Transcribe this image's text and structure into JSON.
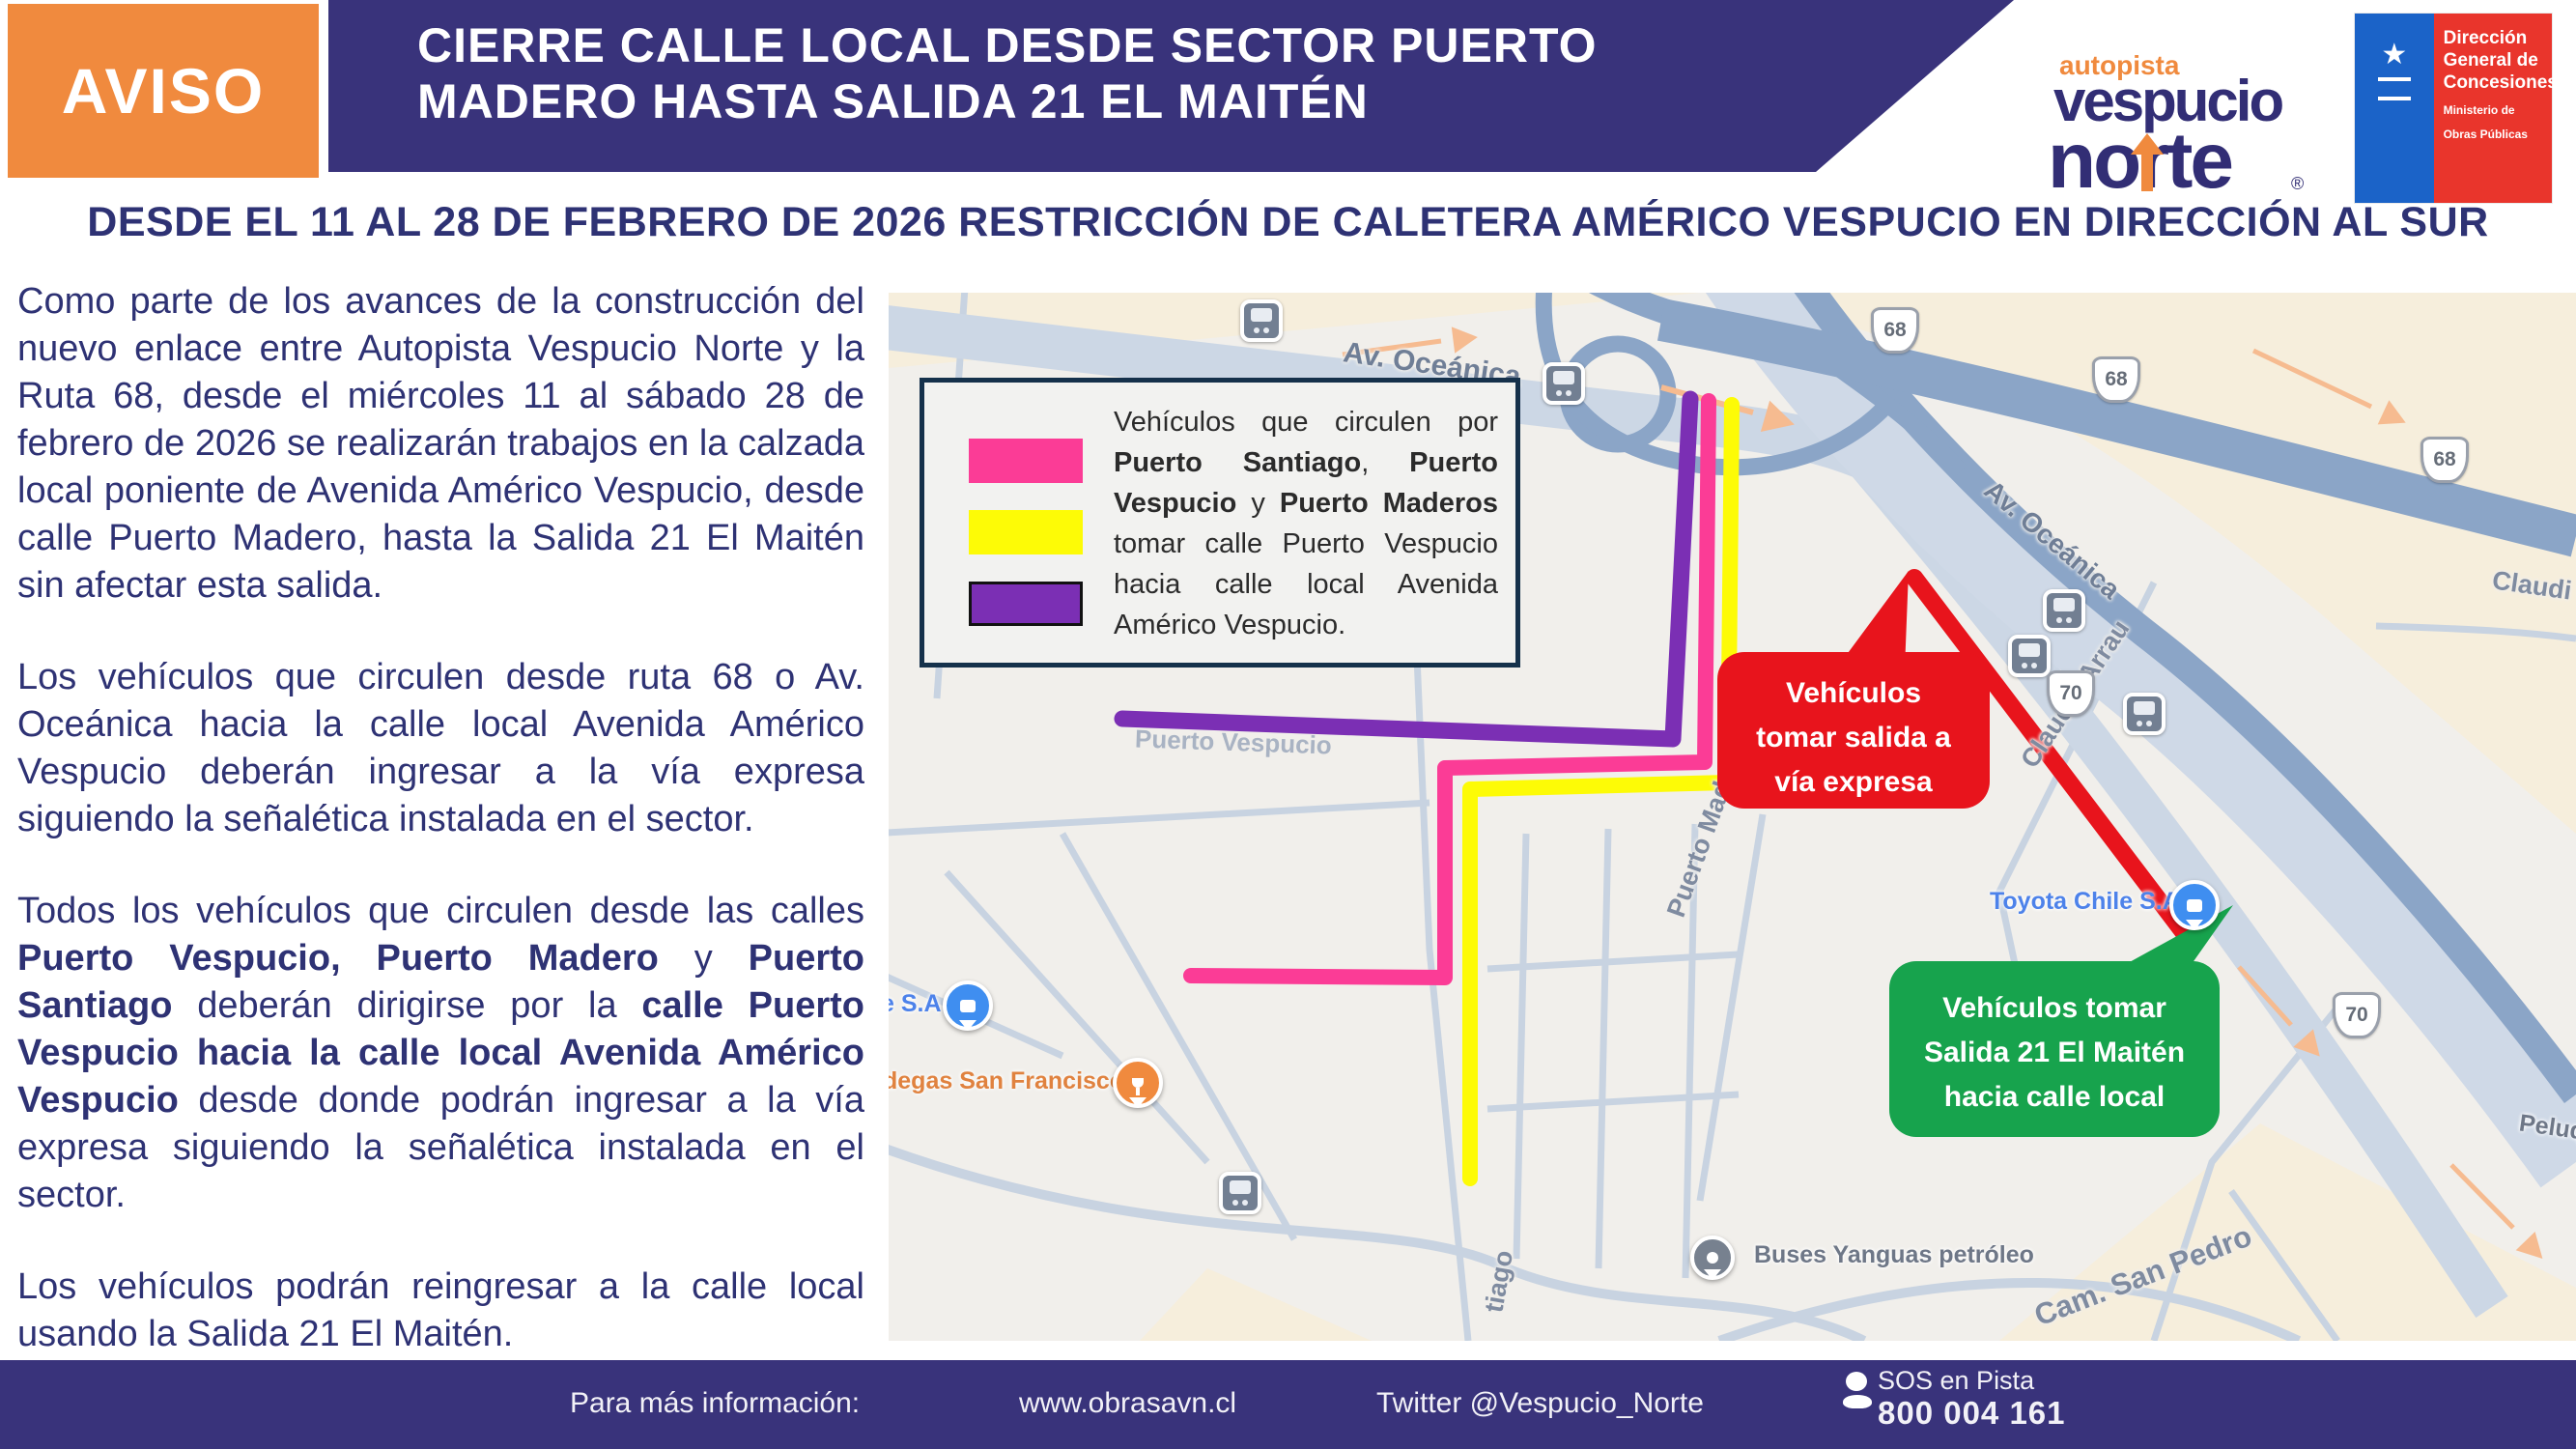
{
  "header": {
    "badge": "AVISO",
    "title_line1": "CIERRE CALLE LOCAL DESDE SECTOR PUERTO",
    "title_line2": "MADERO HASTA SALIDA 21 EL MAITÉN",
    "avn_logo": {
      "autopista": "autopista",
      "vespucio": "vespucio",
      "norte": "norte",
      "registered": "®"
    },
    "gov_logo": {
      "title1": "Dirección",
      "title2": "General de",
      "title3": "Concesiones",
      "ministry1": "Ministerio de",
      "ministry2": "Obras Públicas",
      "emblem": "★"
    }
  },
  "subtitle": "DESDE EL 11 AL 28 DE FEBRERO DE 2026 RESTRICCIÓN DE CALETERA AMÉRICO VESPUCIO EN DIRECCIÓN AL SUR",
  "paragraphs": [
    [
      {
        "t": "Como parte de los avances de la construcción del nuevo enlace entre Autopista Vespucio Norte y la Ruta 68, desde el miércoles 11 al sábado 28 de febrero de 2026 se realizarán trabajos en la calzada local poniente de Avenida Américo Vespucio, desde calle Puerto Madero, hasta la Salida 21 El Maitén sin afectar esta salida.",
        "b": false
      }
    ],
    [
      {
        "t": "Los vehículos que circulen desde ruta 68 o Av. Oceánica hacia la calle local Avenida Américo Vespucio deberán ingresar a la vía expresa siguiendo la señalética instalada en el sector.",
        "b": false
      }
    ],
    [
      {
        "t": "Todos los vehículos que circulen desde las calles ",
        "b": false
      },
      {
        "t": "Puerto Vespucio, Puerto Madero",
        "b": true
      },
      {
        "t": " y ",
        "b": false
      },
      {
        "t": "Puerto Santiago",
        "b": true
      },
      {
        "t": " deberán dirigirse por la ",
        "b": false
      },
      {
        "t": "calle Puerto Vespucio hacia la calle local Avenida Américo Vespucio",
        "b": true
      },
      {
        "t": " desde donde podrán ingresar a la vía expresa siguiendo la señalética instalada en el sector.",
        "b": false
      }
    ],
    [
      {
        "t": "Los vehículos podrán reingresar a la calle local usando la Salida 21 El Maitén.",
        "b": false
      }
    ]
  ],
  "map": {
    "legend": {
      "segments": [
        {
          "t": "Vehículos que circulen por ",
          "b": false
        },
        {
          "t": "Puerto Santiago",
          "b": true
        },
        {
          "t": ", ",
          "b": false
        },
        {
          "t": "Puerto Vespucio",
          "b": true
        },
        {
          "t": " y ",
          "b": false
        },
        {
          "t": "Puerto Maderos",
          "b": true
        },
        {
          "t": " tomar calle Puerto Vespucio hacia calle local Avenida Américo Vespucio.",
          "b": false
        }
      ]
    },
    "callouts": {
      "red": [
        "Vehículos",
        "tomar salida a",
        "vía expresa"
      ],
      "green": [
        "Vehículos tomar",
        "Salida 21 El Maitén",
        "hacia calle local"
      ]
    },
    "street_labels": {
      "av_oceanica": "Av. Oceánica",
      "claudio_arrau": "Claudio Arrau",
      "claudio_partial": "Claudi",
      "puerto_madero": "Puerto Madero",
      "puerto_vespucio": "Puerto Vespucio",
      "santiago_partial": "tiago",
      "cam_san_pedro": "Cam. San Pedro",
      "peluqueria_partial": "Peluq"
    },
    "pois": {
      "esa": "e S.A",
      "bodegas": "degas San Francisco",
      "toyota": "Toyota Chile S.A",
      "buses": "Buses Yanguas petróleo"
    },
    "shields": {
      "r68": "68",
      "r70": "70"
    },
    "colors": {
      "route_pink": "#fb3c96",
      "route_yellow": "#fdfb06",
      "route_purple": "#7b2fb4",
      "route_red": "#e8141c",
      "callout_green": "#17a34d",
      "arrow_peach": "#f6bb90",
      "brand_navy": "#39337b",
      "brand_orange": "#f08a3e"
    }
  },
  "footer": {
    "info": "Para más información:",
    "website": "www.obrasavn.cl",
    "twitter": "Twitter @Vespucio_Norte",
    "sos_label": "SOS en Pista",
    "sos_phone": "800 004 161"
  }
}
